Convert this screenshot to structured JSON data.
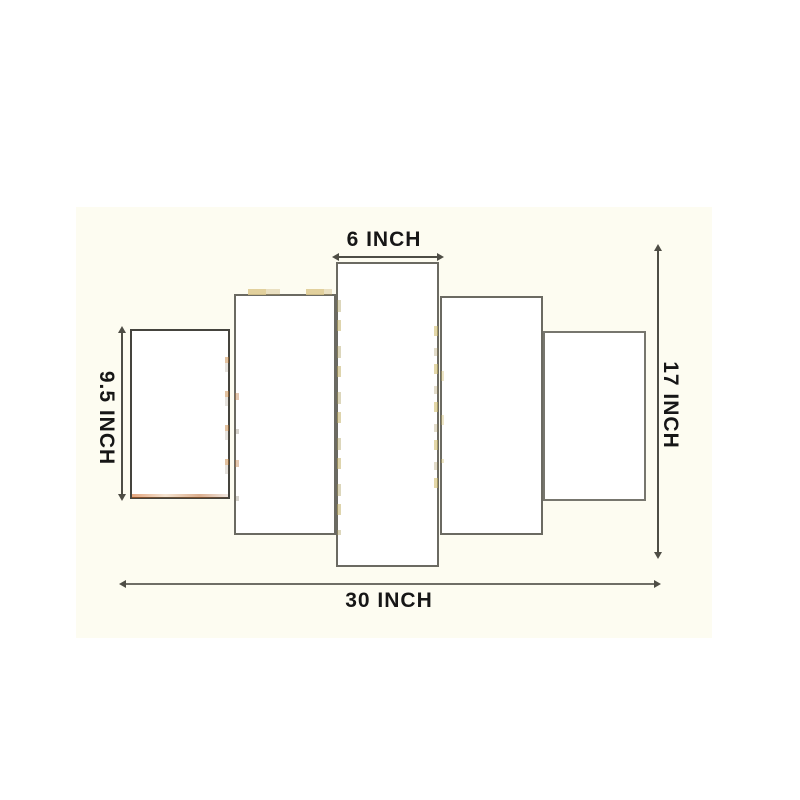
{
  "diagram": {
    "panel_count": 5,
    "annotations": {
      "center_panel_width": "6 INCH",
      "total_width": "30 INCH",
      "total_height": "17 INCH",
      "side_panel_height": "9.5 INCH"
    }
  },
  "colors": {
    "line": "#4e4d45",
    "text": "#161616",
    "diagram-bg": "#fdfcf1",
    "panel-fill": "#ffffff",
    "panel-border": "#6b6a62",
    "panel-border-dark": "#45443e",
    "artifact-orange": "#c27a2e",
    "artifact-tan": "#ddc98e",
    "artifact-olive": "#a89a55"
  }
}
